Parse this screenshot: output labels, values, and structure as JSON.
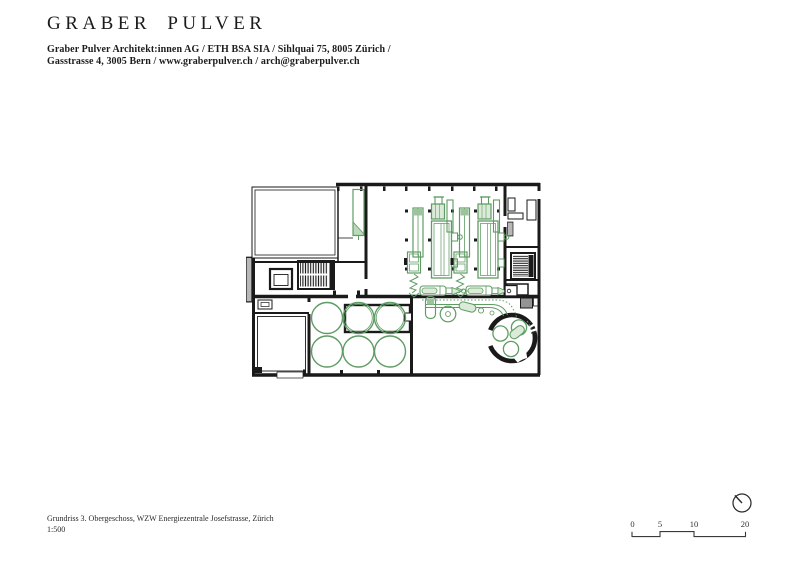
{
  "header": {
    "logo": "GRABER PULVER",
    "address_line1": "Graber Pulver Architekt:innen AG / ETH BSA SIA / Sihlquai 75, 8005 Zürich /",
    "address_line2": "Gasstrasse 4, 3005 Bern / www.graberpulver.ch / arch@graberpulver.ch"
  },
  "footer": {
    "caption_line1": "Grundriss 3. Obergeschoss, WZW Energiezentrale Josefstrasse, Zürich",
    "caption_line2": "1:500"
  },
  "scale_bar": {
    "labels": [
      "0",
      "5",
      "10",
      "20"
    ]
  },
  "drawing": {
    "type": "architectural-floor-plan",
    "colors": {
      "walls": "#1a1a1a",
      "equipment_line": "#5e9c63",
      "equipment_fill": "#dcead9",
      "paper": "#ffffff"
    }
  }
}
